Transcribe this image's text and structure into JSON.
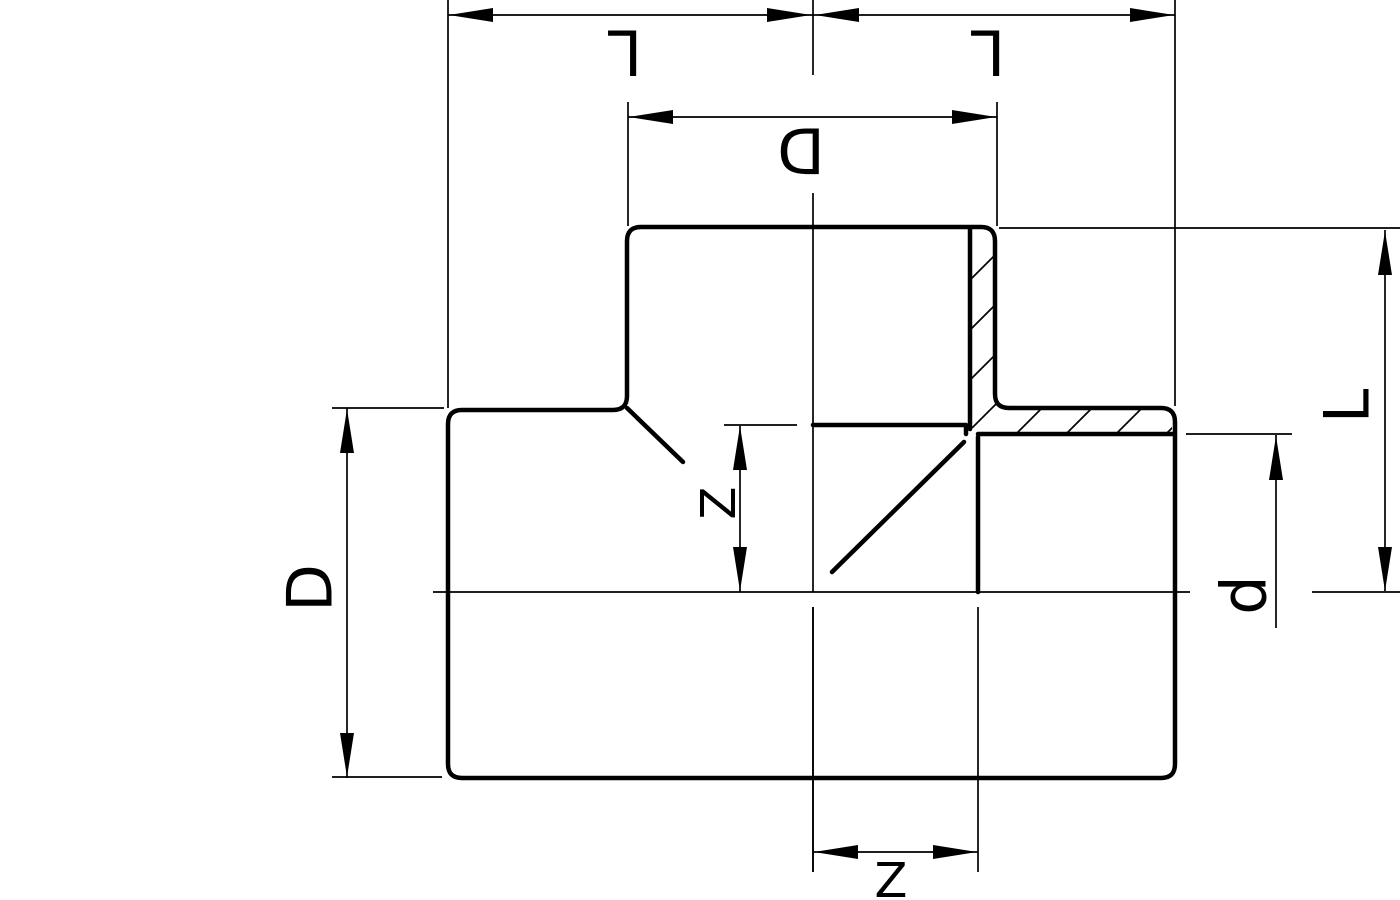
{
  "drawing": {
    "colors": {
      "ink": "#000000",
      "background": "#ffffff"
    },
    "dimension_labels": {
      "top_left_length": "L",
      "top_right_length": "L",
      "branch_outer_diameter": "D",
      "body_outer_diameter": "D",
      "right_length": "L",
      "socket_inner_diameter": "d",
      "mid_socket_depth": "Z",
      "bottom_socket_depth": "Z"
    }
  }
}
